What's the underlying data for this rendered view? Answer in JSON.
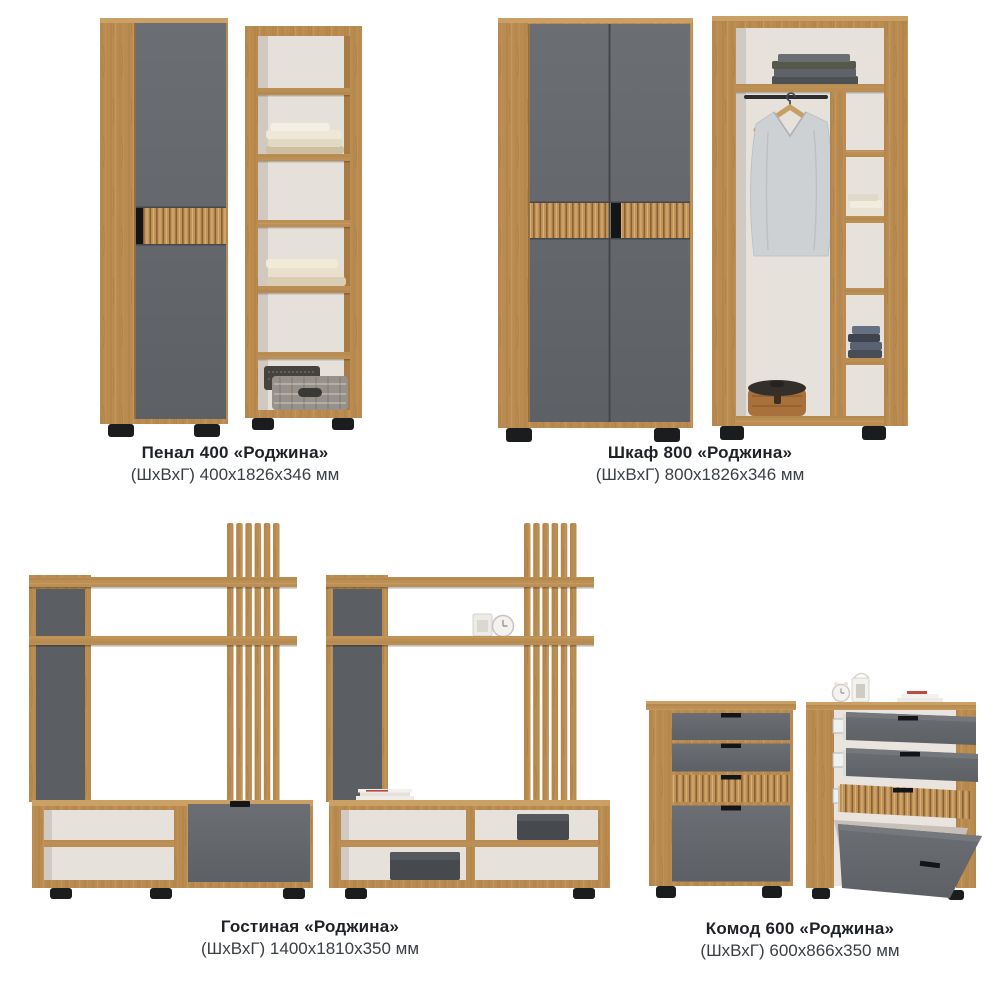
{
  "page": {
    "background": "#ffffff",
    "type_hint": "furniture catalog sheet"
  },
  "palette": {
    "wood": "#b98b51",
    "wood_dark": "#8a6132",
    "wood_light": "#d9af72",
    "graphite": "#64676b",
    "interior_white": "#e5e0da",
    "feet_black": "#1b1c1e",
    "title_text": "#1e2126",
    "dims_text": "#3a3f45"
  },
  "products": [
    {
      "id": "penal-400",
      "name": "Пенал 400 «Роджина»",
      "dimensions": "(ШхВхГ) 400x1826x346 мм"
    },
    {
      "id": "shkaf-800",
      "name": "Шкаф 800 «Роджина»",
      "dimensions": "(ШхВхГ) 800x1826x346 мм"
    },
    {
      "id": "gostinaya",
      "name": "Гостиная «Роджина»",
      "dimensions": "(ШхВхГ) 1400x1810x350 мм"
    },
    {
      "id": "komod-600",
      "name": "Комод 600 «Роджина»",
      "dimensions": "(ШхВхГ) 600x866x350 мм"
    }
  ]
}
